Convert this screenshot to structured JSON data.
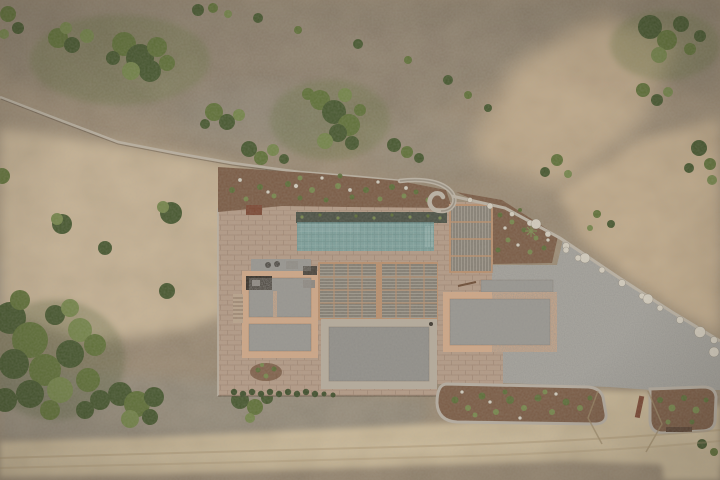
{
  "scene": {
    "type": "aerial-drone-photograph",
    "setting": "dry scrubland hillside",
    "subject": "flat-roofed villa with lap pool, pergolas, gravel court, garden beds and dirt road",
    "elements": {
      "pool": "lap swimming pool",
      "pool_trench": "planted trench along pool",
      "pergolas": "reed pergola canopies",
      "left_wing": "west building with gravel roof",
      "right_wing": "east building with gravel roof",
      "center_roof": "central gravel roof with stone border",
      "driveway": "gravel parking court",
      "spiral_wall": "spiral stone wall",
      "boundary_wall": "dry stone boundary wall",
      "garden_beds": "planted soil beds",
      "road": "sandy dirt road",
      "scrub": "scrubland with bushes"
    }
  },
  "colors": {
    "scrub": "#94836d",
    "scrub_shade": "#7d7262",
    "rock": "#8b867a",
    "sand": "#c6b192",
    "sand_warm": "#c3aa89",
    "road": "#cab795",
    "road_light": "#d4c2a0",
    "soil": "#7a5b45",
    "paving": "#b39a86",
    "terracotta": "#cfa787",
    "gravel_roof": "#9a9893",
    "gravel_dark": "#8f8d88",
    "stone_border": "#b5ab9c",
    "gravel_drive": "#a9a7a1",
    "pool_water": "#7d9f9b",
    "pool_trough": "#4a5044",
    "pergola": "#968f83",
    "pergola_frame": "#b98f6d",
    "wall": "#bbb2a4",
    "hedge": "#3f4f2c",
    "opening": "#37312a",
    "corten": "#7b4733",
    "stair_base": "#b9a38c"
  }
}
